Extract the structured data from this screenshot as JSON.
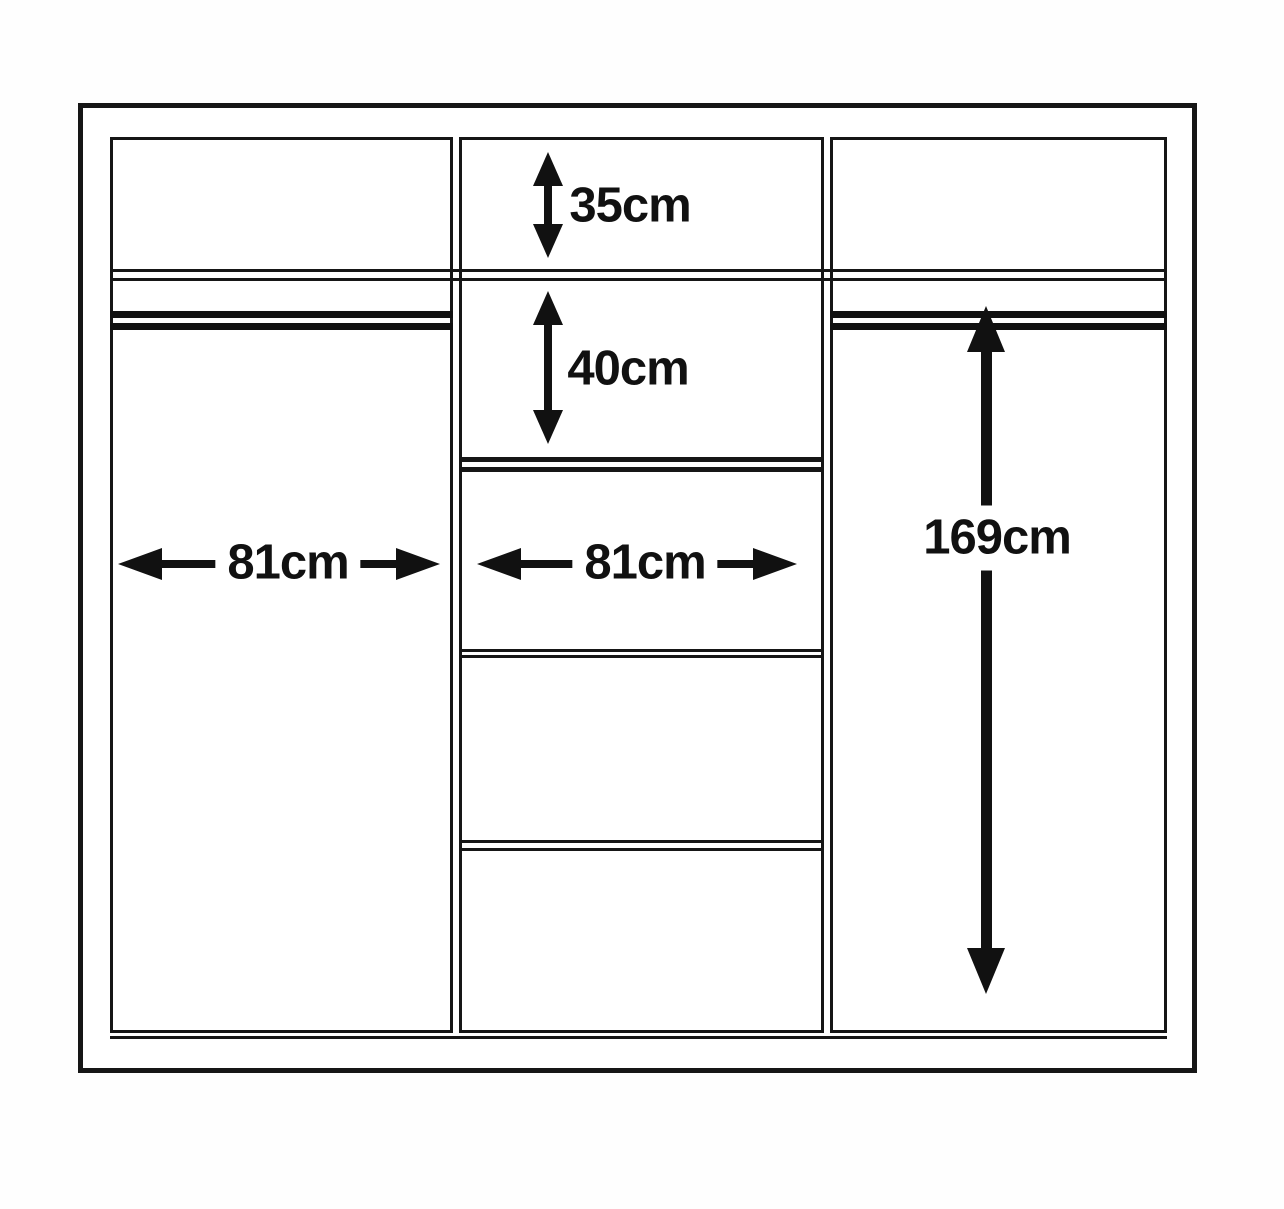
{
  "diagram": {
    "background_color": "#ffffff",
    "line_color": "#161616",
    "dimensions": {
      "top_shelf_height": {
        "label": "35cm",
        "orientation": "vertical"
      },
      "upper_compartment_height": {
        "label": "40cm",
        "orientation": "vertical"
      },
      "left_section_width": {
        "label": "81cm",
        "orientation": "horizontal"
      },
      "middle_section_width": {
        "label": "81cm",
        "orientation": "horizontal"
      },
      "hanging_space_height": {
        "label": "169cm",
        "orientation": "vertical"
      }
    }
  }
}
